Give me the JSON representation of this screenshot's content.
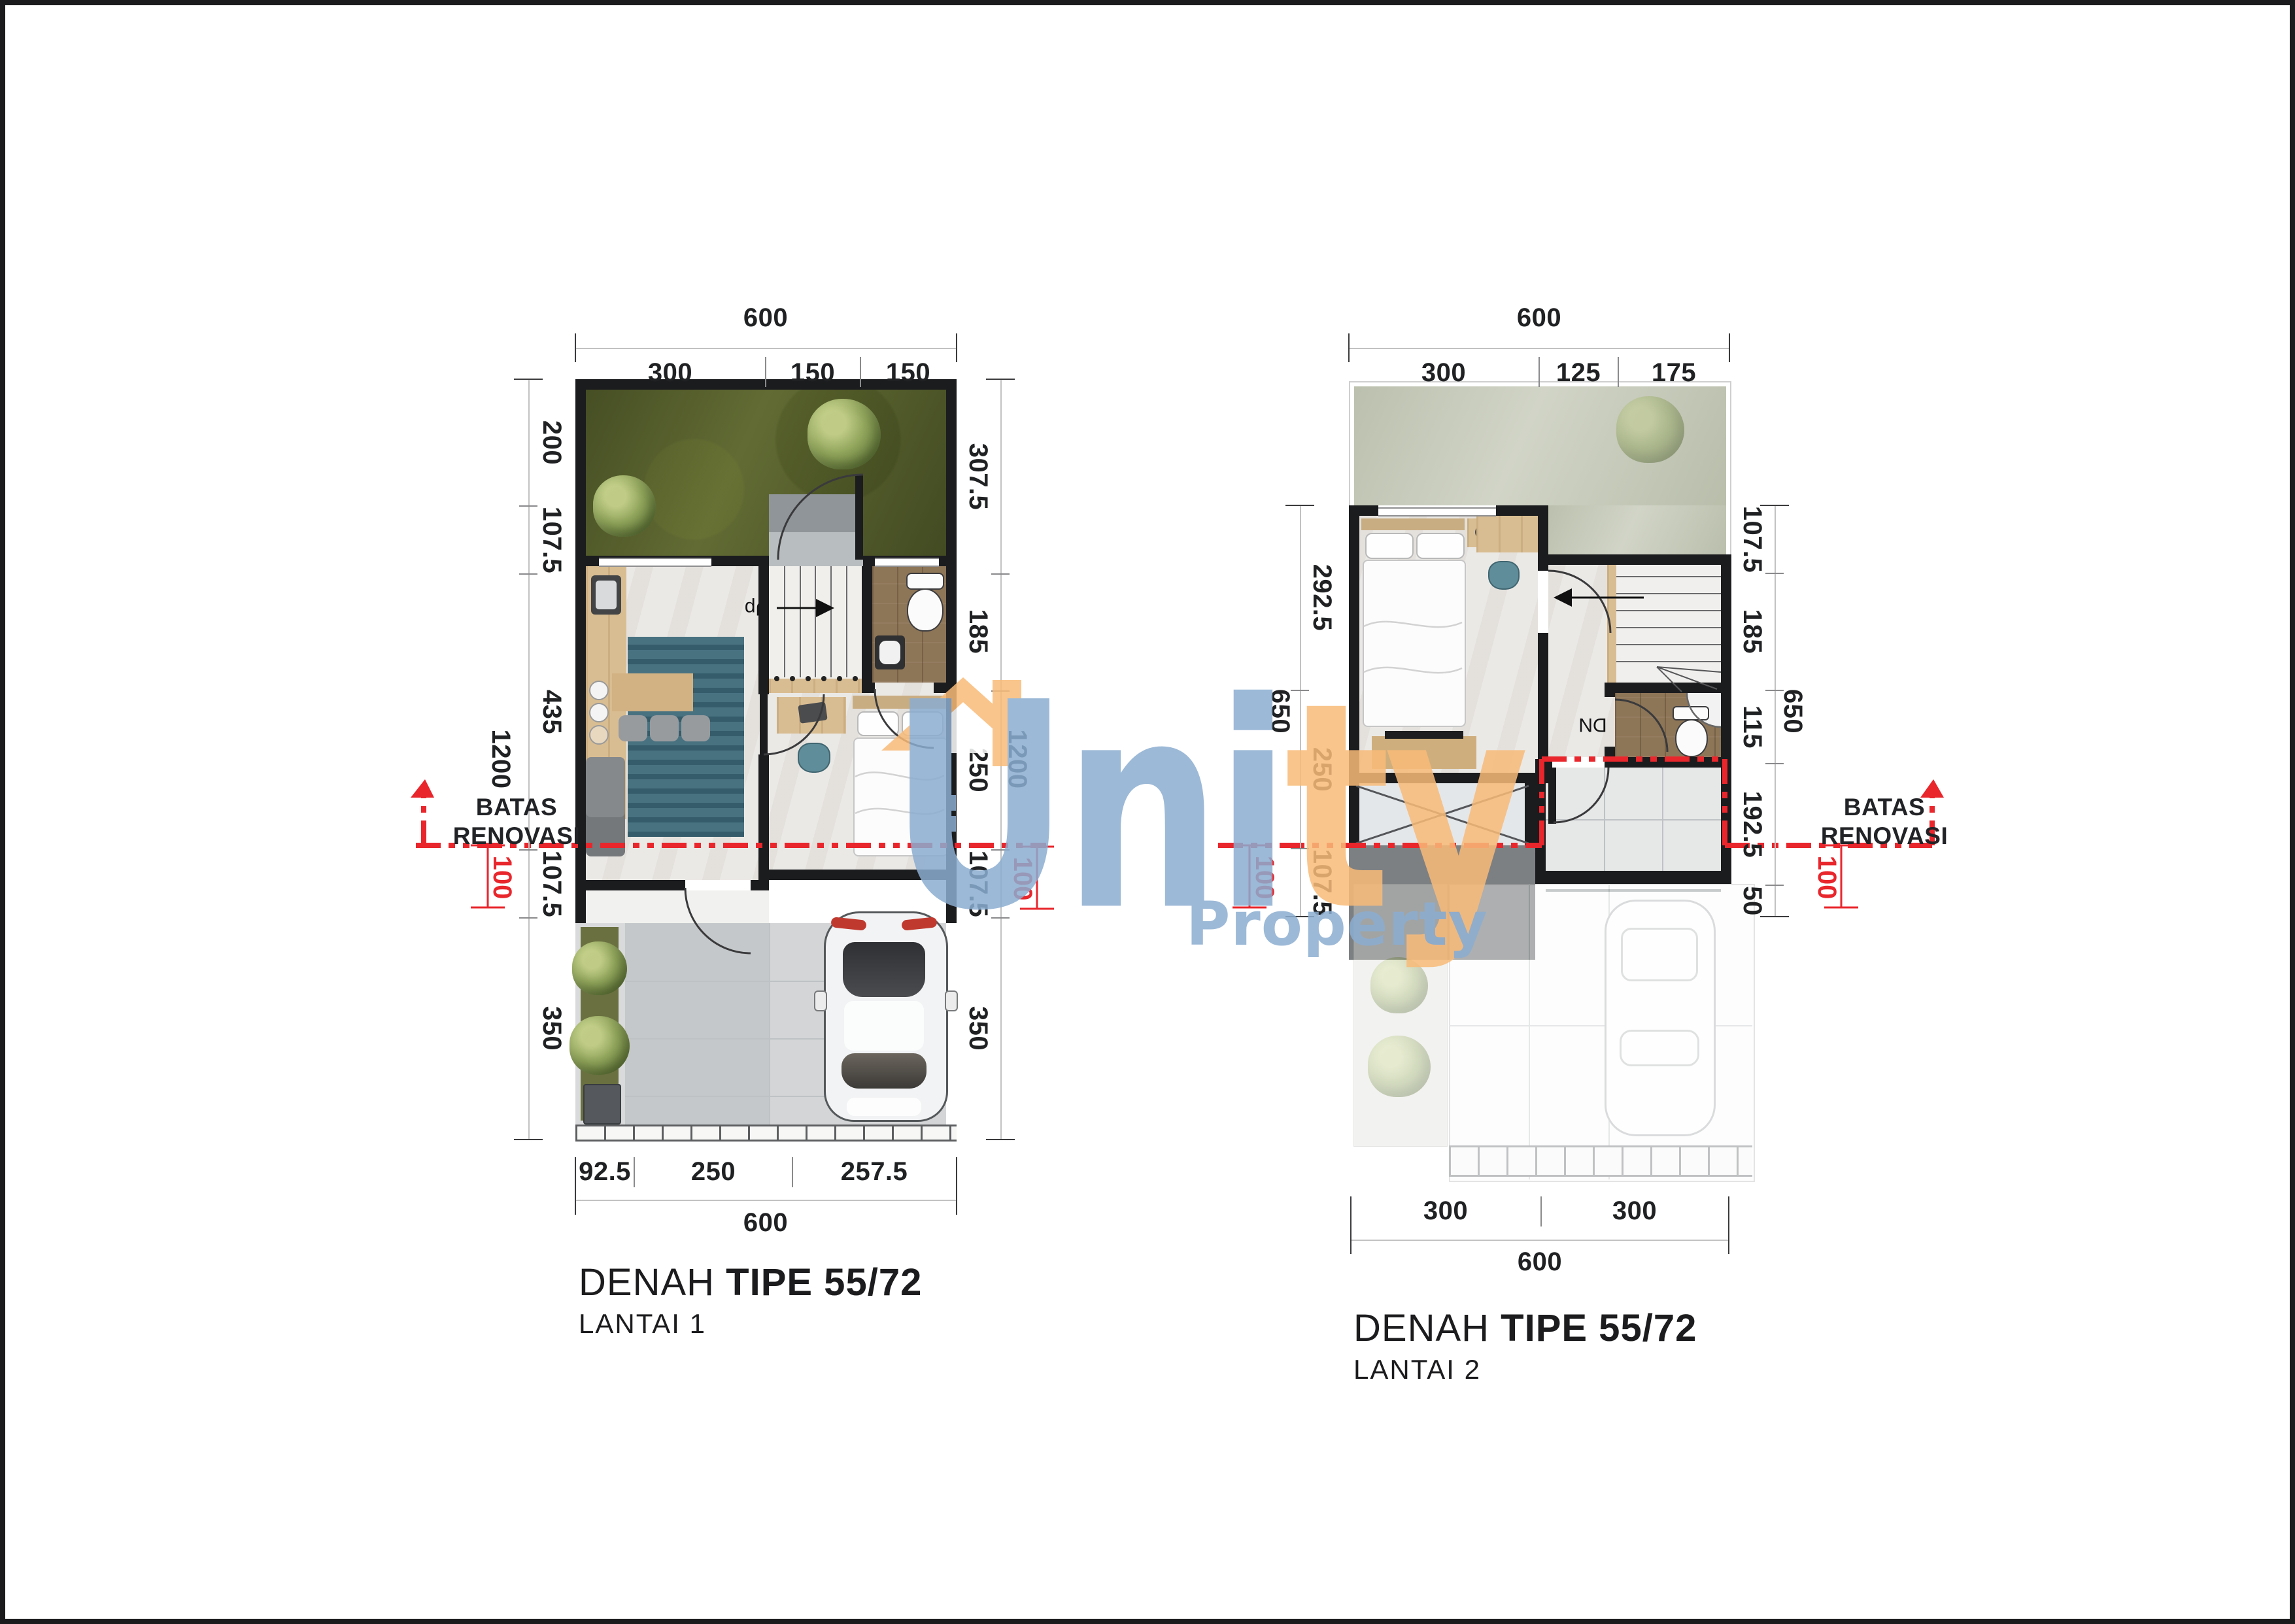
{
  "logo": {
    "word_blue": "Uni",
    "word_orange": "ty",
    "subtitle": "Property",
    "colors": {
      "blue": "#8badd1",
      "orange": "#f9bb79",
      "red": "#e8262c"
    },
    "icons": [
      "house-roof-icon",
      "chimney-icon",
      "window-icon"
    ]
  },
  "p1": {
    "title_prefix": "DENAH ",
    "title_type": "TIPE 55/72",
    "floor": "LANTAI 1",
    "stairs_label": "Up",
    "top": {
      "total": "600",
      "segs": [
        "300",
        "150",
        "150"
      ]
    },
    "bottom": {
      "total": "600",
      "segs": [
        "92.5",
        "250",
        "257.5"
      ]
    },
    "left": {
      "total": "1200",
      "segs": [
        "200",
        "107.5",
        "435",
        "107.5",
        "350"
      ]
    },
    "right": {
      "total": "1200",
      "segs": [
        "307.5",
        "185",
        "250",
        "107.5",
        "350"
      ]
    },
    "batas": {
      "line1": "BATAS",
      "line2": "RENOVASI",
      "offset": "100"
    }
  },
  "p2": {
    "title_prefix": "DENAH ",
    "title_type": "TIPE 55/72",
    "floor": "LANTAI 2",
    "stairs_label": "DN",
    "top": {
      "total": "600",
      "segs": [
        "300",
        "125",
        "175"
      ]
    },
    "bottom": {
      "total": "600",
      "segs": [
        "300",
        "300"
      ]
    },
    "left": {
      "total": "650",
      "segs": [
        "292.5",
        "250",
        "107.5"
      ]
    },
    "right": {
      "total": "650",
      "segs": [
        "107.5",
        "185",
        "115",
        "192.5",
        "50"
      ]
    },
    "batas": {
      "line1": "BATAS",
      "line2": "RENOVASI",
      "offset": "100"
    }
  }
}
